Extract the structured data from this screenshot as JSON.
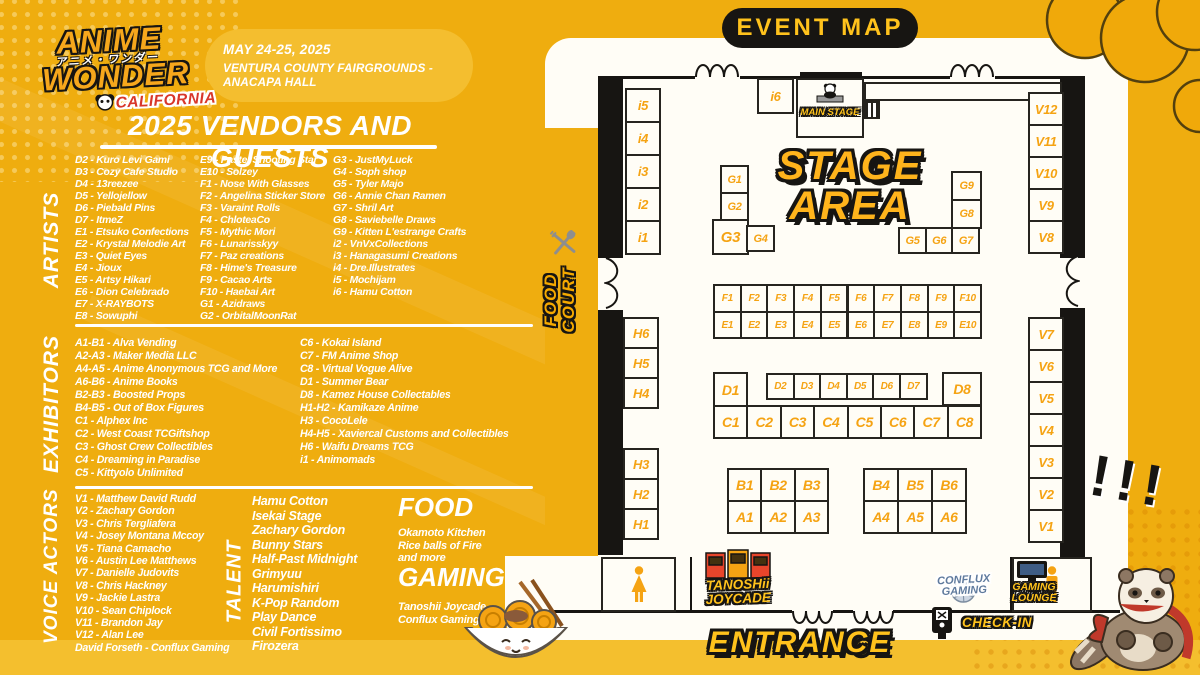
{
  "event": {
    "logo_line1": "ANIME",
    "logo_line2": "WONDER",
    "logo_jp": "アニメ・ワンダー",
    "logo_region": "CALIFORNIA",
    "date": "MAY 24-25, 2025",
    "venue": "VENTURA COUNTY FAIRGROUNDS - ANACAPA HALL",
    "list_title": "2025 VENDORS AND GUESTS"
  },
  "sections": {
    "artists": {
      "label": "ARTISTS",
      "columns": [
        [
          "D2 - Kuro Levi Gami",
          "D3 - Cozy Cafe Studio",
          "D4 - 13reezee",
          "D5 - Yellojellow",
          "D6 - Piebald Pins",
          "D7 - ItmeZ",
          "E1 - Etsuko Confections",
          "E2 - Krystal Melodie Art",
          "E3 - Quiet Eyes",
          "E4 - Jioux",
          "E5 - Artsy Hikari",
          "E6 - Dion Celebrado",
          "E7 - X-RAYBOTS",
          "E8 - Sowuphi"
        ],
        [
          "E9 - Pastel Shooting Star",
          "E10 - Solzey",
          "F1 - Nose With Glasses",
          "F2 - Angelina Sticker Store",
          "F3 - Varaint Rolls",
          "F4 - ChloteaCo",
          "F5 - Mythic Mori",
          "F6 - Lunarisskyy",
          "F7 - Paz creations",
          "F8 - Hime's Treasure",
          "F9 - Cacao Arts",
          "F10 - Haebai Art",
          "G1 - Azidraws",
          "G2 - OrbitalMoonRat"
        ],
        [
          "G3 - JustMyLuck",
          "G4 - Soph shop",
          "G5 - Tyler Majo",
          "G6 - Annie Chan Ramen",
          "G7 - Shril Art",
          "G8 - Saviebelle Draws",
          "G9 - Kitten L'estrange Crafts",
          "i2 - VnVxCollections",
          "i3 - Hanagasumi Creations",
          "i4 - Dre.Illustrates",
          "i5 - Mochijam",
          "i6 - Hamu Cotton"
        ]
      ]
    },
    "exhibitors": {
      "label": "EXHIBITORS",
      "columns": [
        [
          "A1-B1 - Alva Vending",
          "A2-A3 - Maker Media LLC",
          "A4-A5 - Anime Anonymous TCG and More",
          "A6-B6 - Anime Books",
          "B2-B3 - Boosted Props",
          "B4-B5 - Out of Box Figures",
          "C1 - Alphex Inc",
          "C2 - West Coast TCGiftshop",
          "C3 - Ghost Crew Collectibles",
          "C4 - Dreaming in Paradise",
          "C5 - Kittyolo Unlimited"
        ],
        [
          "C6 - Kokai Island",
          "C7 - FM Anime Shop",
          "C8 - Virtual Vogue Alive",
          "D1 - Summer Bear",
          "D8 - Kamez House Collectables",
          "H1-H2 - Kamikaze Anime",
          "H3 - CocoLele",
          "H4-H5 - Xaviercal Customs and Collectibles",
          "H6 - Waifu Dreams TCG",
          "i1 - Animomads"
        ]
      ]
    },
    "voice_actors": {
      "label": "VOICE ACTORS",
      "items": [
        "V1 - Matthew David Rudd",
        "V2 - Zachary Gordon",
        "V3 - Chris Tergliafera",
        "V4 - Josey Montana Mccoy",
        "V5 - Tiana Camacho",
        "V6 - Austin Lee Matthews",
        "V7 - Danielle Judovits",
        "V8 - Chris Hackney",
        "V9 - Jackie Lastra",
        "V10 - Sean Chiplock",
        "V11 - Brandon Jay",
        "V12 - Alan Lee",
        "David Forseth - Conflux Gaming"
      ]
    },
    "talent": {
      "label": "TALENT",
      "items": [
        "Hamu Cotton",
        "Isekai Stage",
        "Zachary Gordon",
        "Bunny Stars",
        "Half-Past Midnight",
        "Grimyuu",
        "Harumishiri",
        "K-Pop Random",
        "Play Dance",
        "Civil Fortissimo",
        "Firozera"
      ]
    },
    "food": {
      "label": "FOOD",
      "items": [
        "Okamoto Kitchen",
        "Rice balls of Fire",
        "and more"
      ]
    },
    "gaming": {
      "label": "GAMING",
      "items": [
        "Tanoshii Joycade",
        "Conflux Gaming Lounge"
      ]
    }
  },
  "map": {
    "title": "EVENT MAP",
    "main_stage": "MAIN STAGE",
    "stage_line1": "STAGE",
    "stage_line2": "AREA",
    "food_court_line1": "FOOD",
    "food_court_line2": "COURT",
    "entrance": "ENTRANCE",
    "check_in": "CHECK-IN",
    "tanoshii_line1": "TANOSHii",
    "tanoshii_line2": "JOYCADE",
    "conflux_line1": "CONFLUX",
    "conflux_line2": "GAMING",
    "lounge_line1": "GAMING",
    "lounge_line2": "LOUNGE",
    "exclaim": "!!!",
    "booth_labels": [
      "i5",
      "i4",
      "i3",
      "i2",
      "i1",
      "i6",
      "H6",
      "H5",
      "H4",
      "H3",
      "H2",
      "H1",
      "V12",
      "V11",
      "V10",
      "V9",
      "V8",
      "V7",
      "V6",
      "V5",
      "V4",
      "V3",
      "V2",
      "V1",
      "G1",
      "G2",
      "G3",
      "G4",
      "G5",
      "G6",
      "G7",
      "G8",
      "G9",
      "F1",
      "F2",
      "F3",
      "F4",
      "F5",
      "F6",
      "F7",
      "F8",
      "F9",
      "F10",
      "E1",
      "E2",
      "E3",
      "E4",
      "E5",
      "E6",
      "E7",
      "E8",
      "E9",
      "E10",
      "D1",
      "D2",
      "D3",
      "D4",
      "D5",
      "D6",
      "D7",
      "D8",
      "C1",
      "C2",
      "C3",
      "C4",
      "C5",
      "C6",
      "C7",
      "C8",
      "B1",
      "B2",
      "B3",
      "A1",
      "A2",
      "A3",
      "B4",
      "B5",
      "B6",
      "A4",
      "A5",
      "A6"
    ]
  },
  "colors": {
    "background": "#EFAD0F",
    "band": "#F4BF2E",
    "booth_label": "#F5A313",
    "pill": "#F4BE2F",
    "map_pill_bg": "#171512",
    "map_pill_text": "#FFC21C",
    "logo_orange": "#F6A71C",
    "logo_red": "#D8372A"
  }
}
